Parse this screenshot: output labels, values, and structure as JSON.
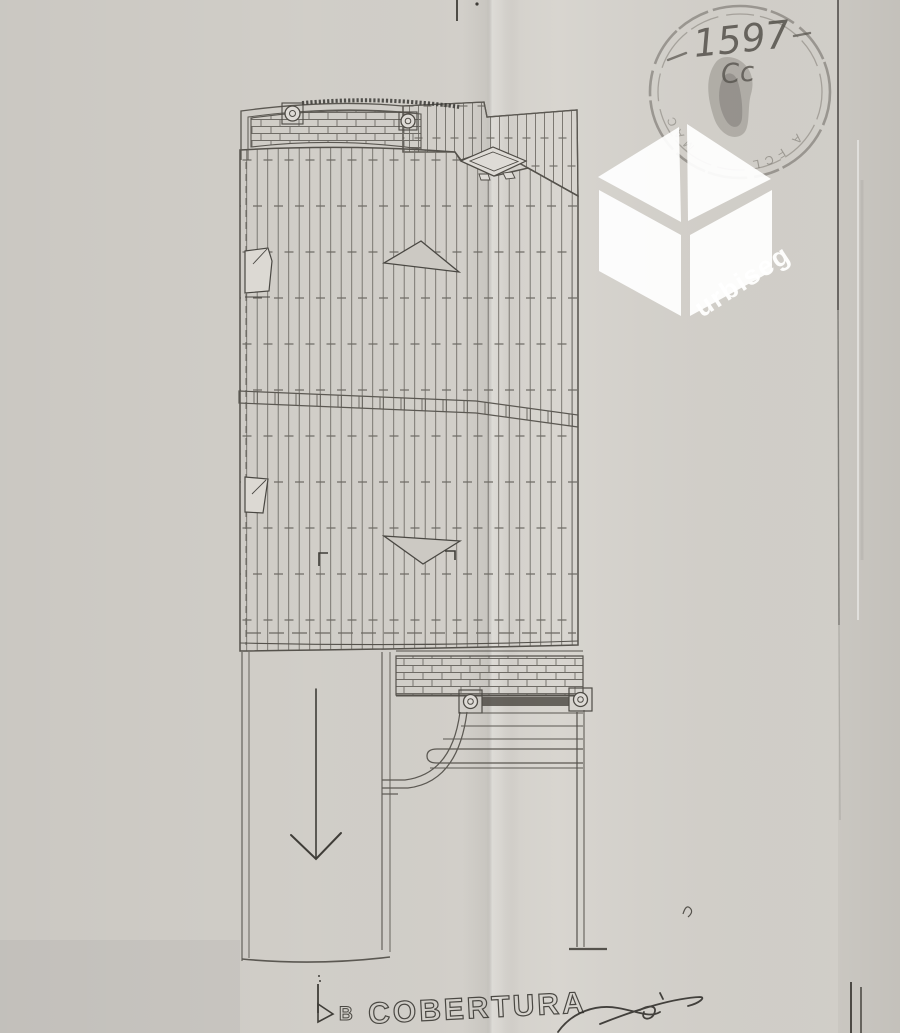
{
  "paper": {
    "background": "#d5d2cc",
    "ink": "#5f5c56",
    "dark_ink": "#3f3d38"
  },
  "plan": {
    "title": "COBERTURA",
    "bottom_section_marker": "B"
  },
  "stamp": {
    "number": "1597",
    "monogram": "Cc",
    "rim_fragment_bottom": "A FCL",
    "rim_fragment_left": "MAC",
    "ink_color": "#45423c"
  },
  "watermark": {
    "brand": "urbiseg",
    "color": "#ffffff",
    "icon": "open-box-cube-icon"
  }
}
